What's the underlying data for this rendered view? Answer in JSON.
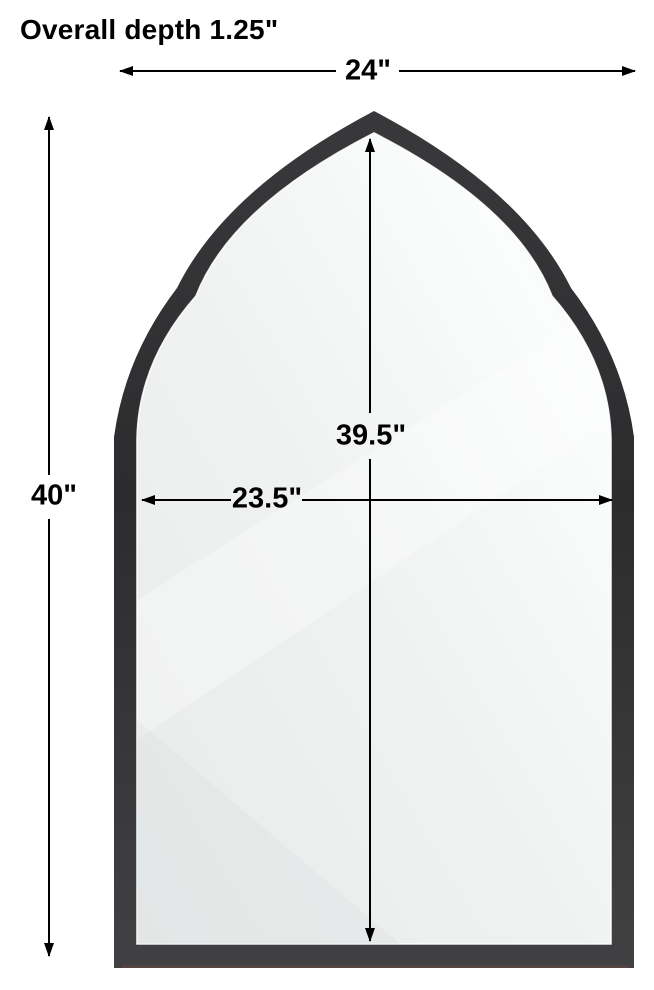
{
  "diagram": {
    "annotations": {
      "depth": "Overall depth 1.25\"",
      "overall_width": "24\"",
      "overall_height": "40\"",
      "inner_height": "39.5\"",
      "inner_width": "23.5\""
    },
    "colors": {
      "dimension_line": "#000000",
      "label_text": "#000000",
      "frame_dark": "#2c2c2e",
      "frame_light": "#414143",
      "glass_shadow": "#e8eaea",
      "glass_light": "#fbfcfc",
      "glass_edge_line": "#ffffff",
      "background": "#ffffff"
    }
  }
}
